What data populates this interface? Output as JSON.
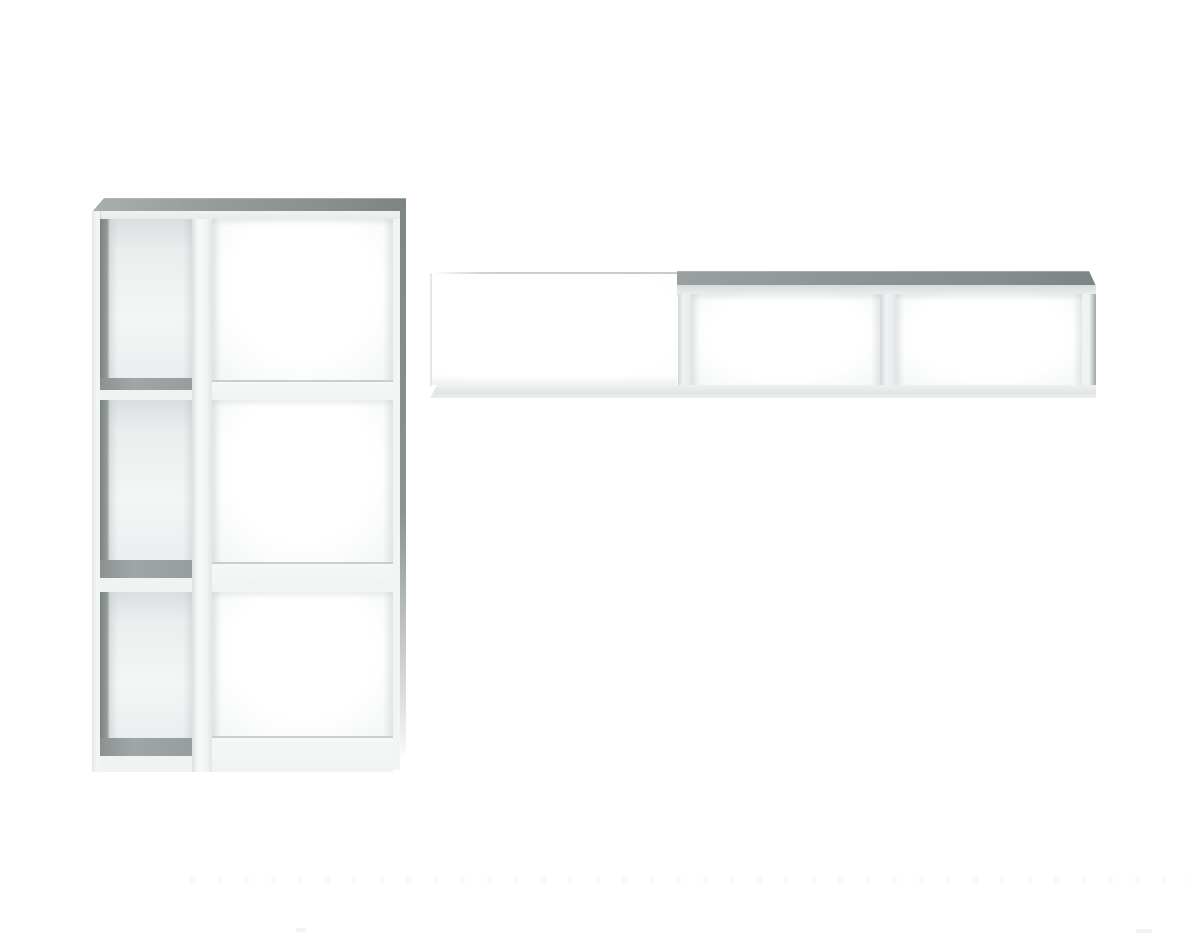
{
  "scene": {
    "description": "Studio product photo on a plain white background: a tall white open-back shelving unit with a narrow column of three compartments and a wide column of three compartments on the left, and a long white wall-mounted horizontal shelf with one long open section and two boxed compartments on the right.",
    "background": "#ffffff"
  },
  "objects": {
    "bookcase": {
      "name": "open shelving unit",
      "finish": "white",
      "columns": 2,
      "narrow_column_compartments": 3,
      "wide_column_compartments": 3,
      "total_compartments": 6
    },
    "wall_shelf": {
      "name": "horizontal wall shelf",
      "finish": "white",
      "open_sections": 1,
      "boxed_compartments": 2
    }
  },
  "colors": {
    "background": "#ffffff",
    "band_light": "#a9afaf",
    "band_dark": "#7d8484",
    "frame_white": "#f3f5f5",
    "inner_wall_dark": "#848b8b",
    "shelf_surface": "#a0a6a6",
    "divider_front": "#f1f3f3",
    "thin_line": "#c9cfcf",
    "side_edge": "#8b9292",
    "bottom_strip_light": "#eef1f1",
    "bottom_strip_dark": "#e2e6e6"
  }
}
